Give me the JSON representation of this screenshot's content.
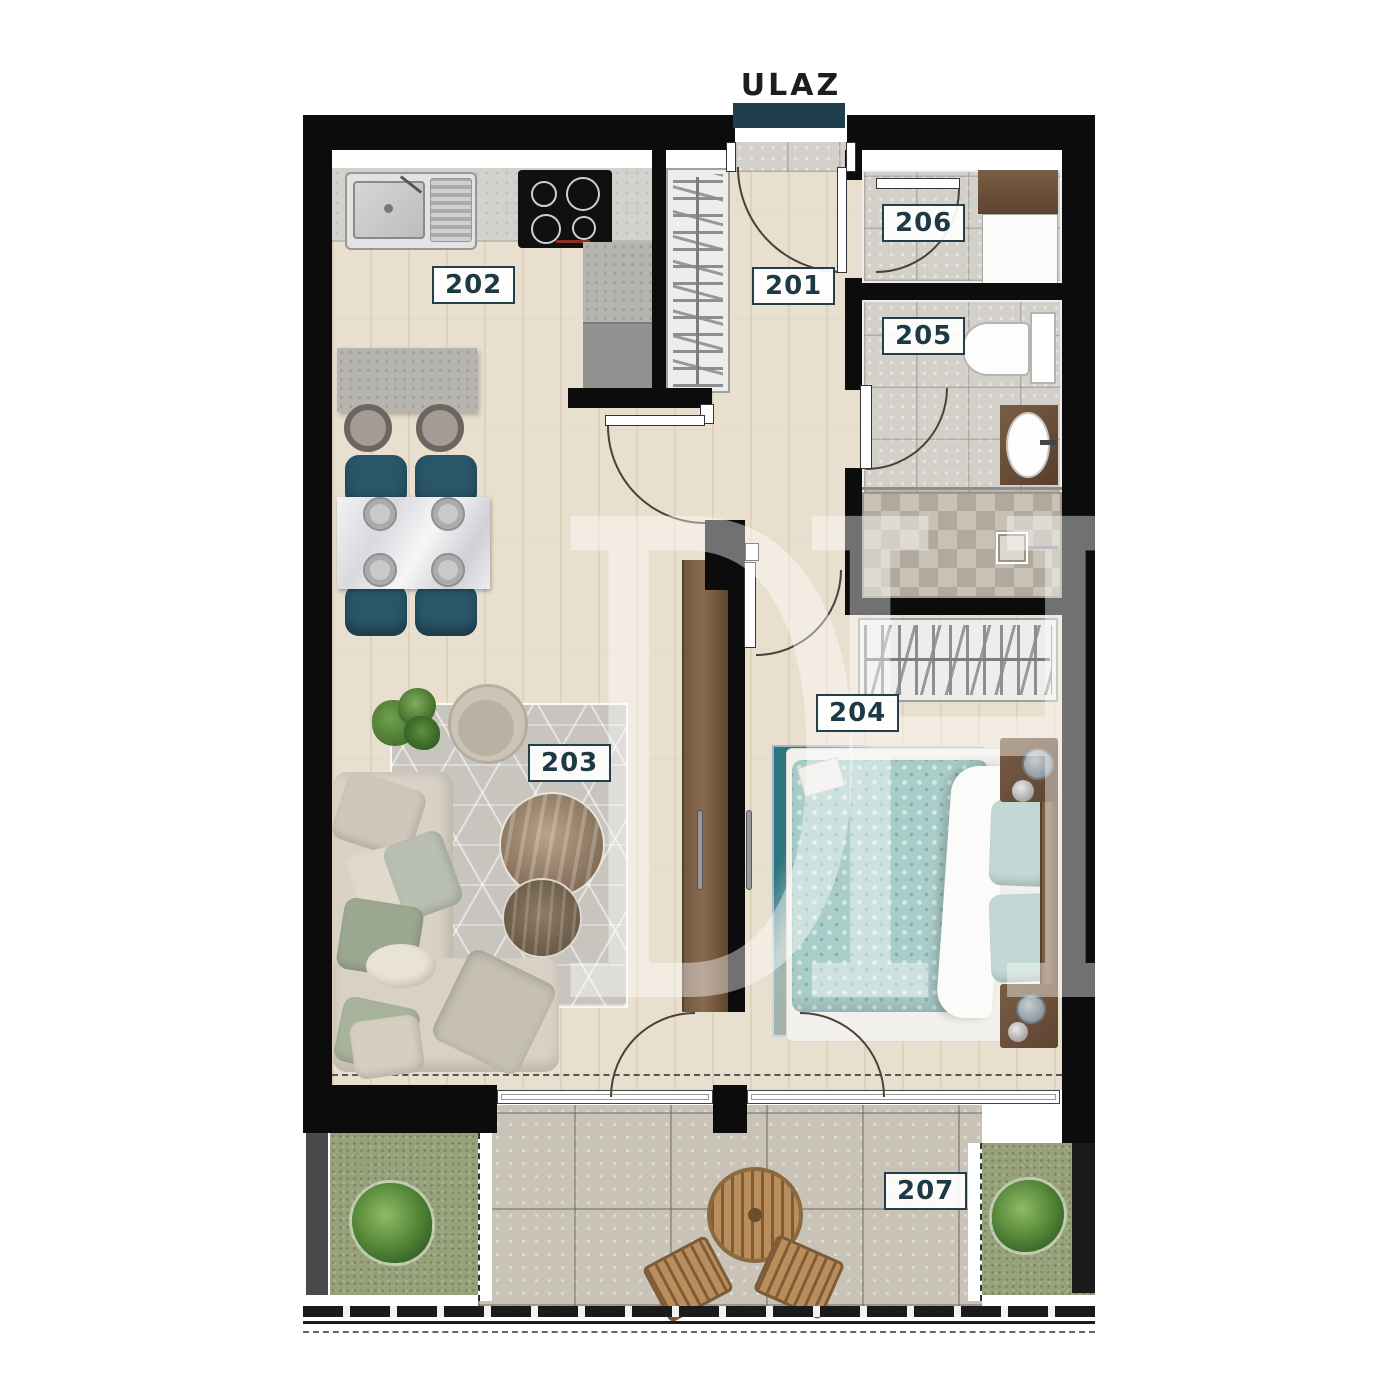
{
  "entrance": {
    "label": "ULAZ"
  },
  "rooms": [
    {
      "number": "201"
    },
    {
      "number": "202"
    },
    {
      "number": "203"
    },
    {
      "number": "204"
    },
    {
      "number": "205"
    },
    {
      "number": "206"
    },
    {
      "number": "207"
    }
  ],
  "watermark": {
    "text": "DH"
  },
  "colors": {
    "wall": "#0c0c0c",
    "entrance_bar": "#1f3f4c",
    "label_border": "#233f4a",
    "label_text": "#1c3945",
    "dining_chair_teal": "#2a5669",
    "bed_duvet_teal": "#a9cdc9",
    "bed_rug_teal": "#2e7580",
    "wood_floor": "#e9dfce",
    "terrace_stone": "#c9c2b6",
    "grass": "#97a17b"
  }
}
